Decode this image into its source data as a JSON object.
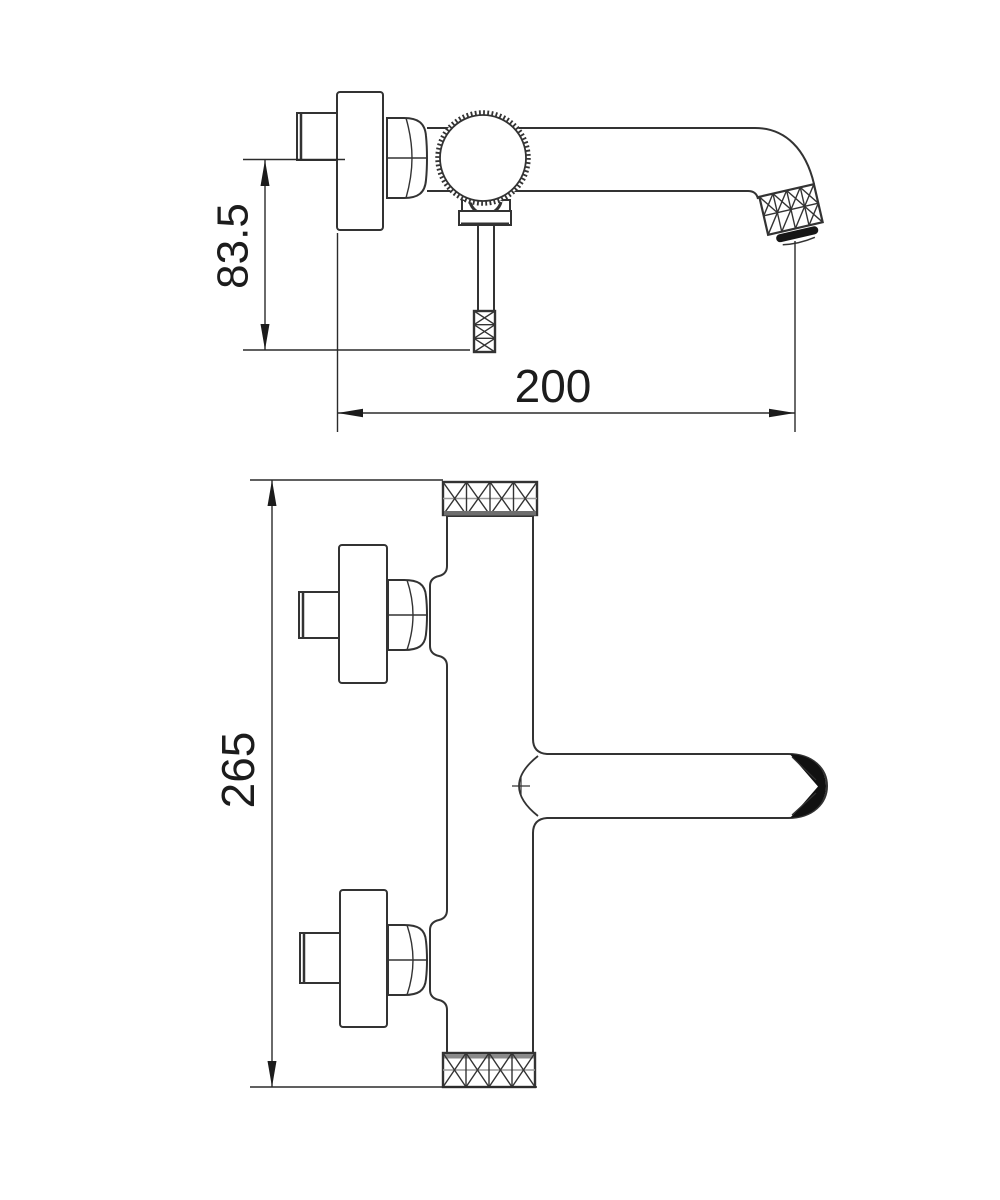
{
  "drawing": {
    "background_color": "#ffffff",
    "line_color": "#333333",
    "text_color": "#1c1c1c",
    "dimensions": {
      "mount_to_handle": "83.5",
      "spout_reach": "200",
      "body_height": "265"
    }
  }
}
